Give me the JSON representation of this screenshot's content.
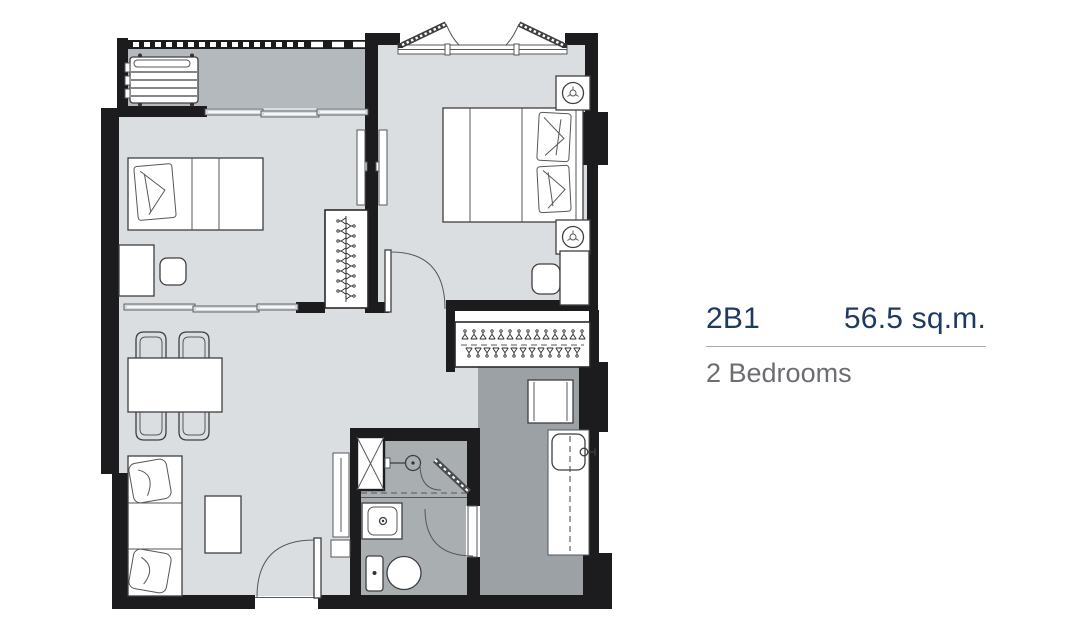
{
  "unit": {
    "code": "2B1",
    "area": "56.5 sq.m.",
    "type": "2 Bedrooms"
  },
  "colors": {
    "wall": "#1c1c1e",
    "floor_light": "#dbdee0",
    "floor_balcony": "#b3b9bd",
    "floor_kitchen": "#9ca1a5",
    "floor_bath": "#a9aeb1",
    "accent_text": "#1e3a64",
    "secondary_text": "#6b6d70",
    "divider_line": "#a8abae",
    "furniture_line": "#3f3f41"
  }
}
